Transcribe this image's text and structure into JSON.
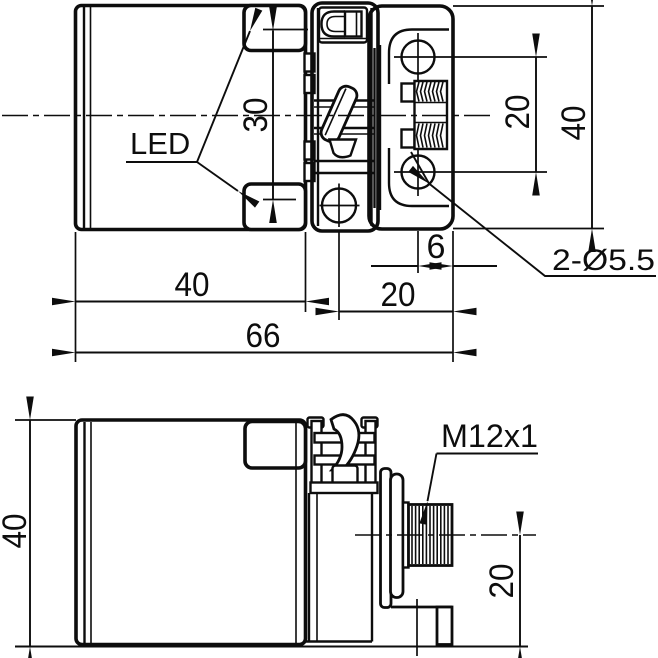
{
  "drawing": {
    "background_color": "#ffffff",
    "line_color": "#0d0d0d",
    "top_view": {
      "led_label": "LED",
      "dim_led_spacing": "30",
      "dim_body_width": "40",
      "dim_overall_length": "66",
      "dim_hole_to_bracket_end": "20",
      "dim_hole_to_end": "6",
      "holes_callout": "2-Ø5.5",
      "dim_hole_spacing": "20",
      "dim_bracket_height": "40"
    },
    "side_view": {
      "connector_callout": "M12x1",
      "dim_body_height": "40",
      "dim_connector_center_height": "20"
    }
  }
}
